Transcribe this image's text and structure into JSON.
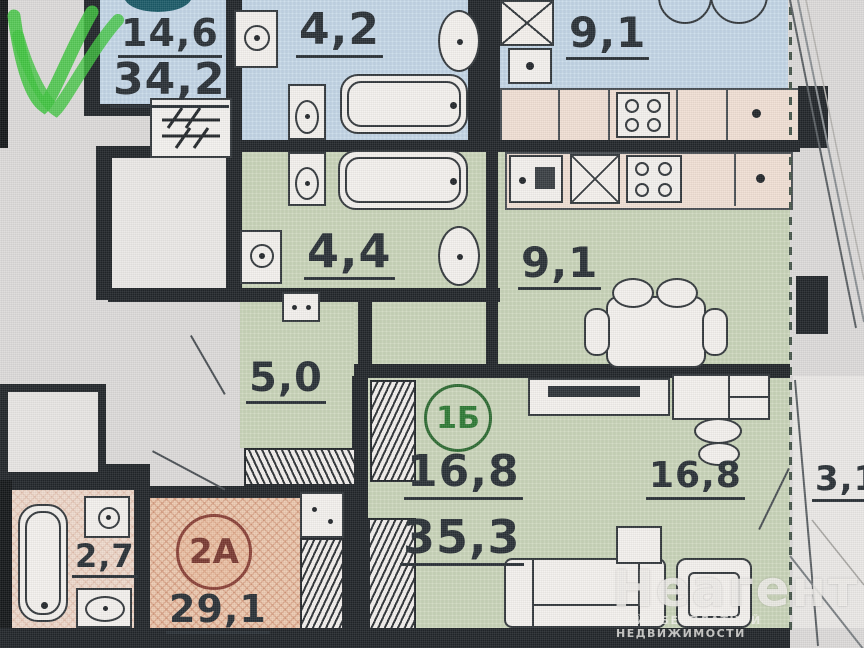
{
  "plan_type": "apartment-floor-plan",
  "rooms": {
    "studio_top": {
      "area": "14,6",
      "total": "34,2"
    },
    "bath_top": {
      "area": "4,2"
    },
    "kitchen_top": {
      "area": "9,1"
    },
    "bath_mid": {
      "area": "4,4"
    },
    "kitchen_mid": {
      "area": "9,1"
    },
    "hall": {
      "area": "5,0"
    },
    "flat_1b": {
      "badge": "1Б",
      "area_room": "16,8",
      "area_total": "35,3",
      "area_living": "16,8"
    },
    "balcony": {
      "area": "3,1"
    },
    "bath_2a": {
      "area": "2,7"
    },
    "flat_2a": {
      "badge": "2А",
      "area_total": "29,1"
    }
  },
  "watermark": {
    "brand": "Неагент",
    "tagline": "САЙТ БЕСПЛАТНОЙ НЕДВИЖИМОСТИ"
  },
  "icons": {
    "approved_checkmark": "✓",
    "washing_machine": "square-with-circle",
    "stove": "four-burners",
    "ventilation": "box-with-x"
  },
  "colors": {
    "room_blue": "#c9dbea",
    "room_green": "#cfd9bf",
    "room_pink": "#eedacd",
    "room_orange": "#ecc9b0",
    "wall": "#22262a",
    "checkmark_green": "#3ec43e",
    "badge_1b": "#2e7a35",
    "badge_2a": "#8a4238",
    "text": "#2a3137",
    "watermark": "#f0eeea"
  }
}
